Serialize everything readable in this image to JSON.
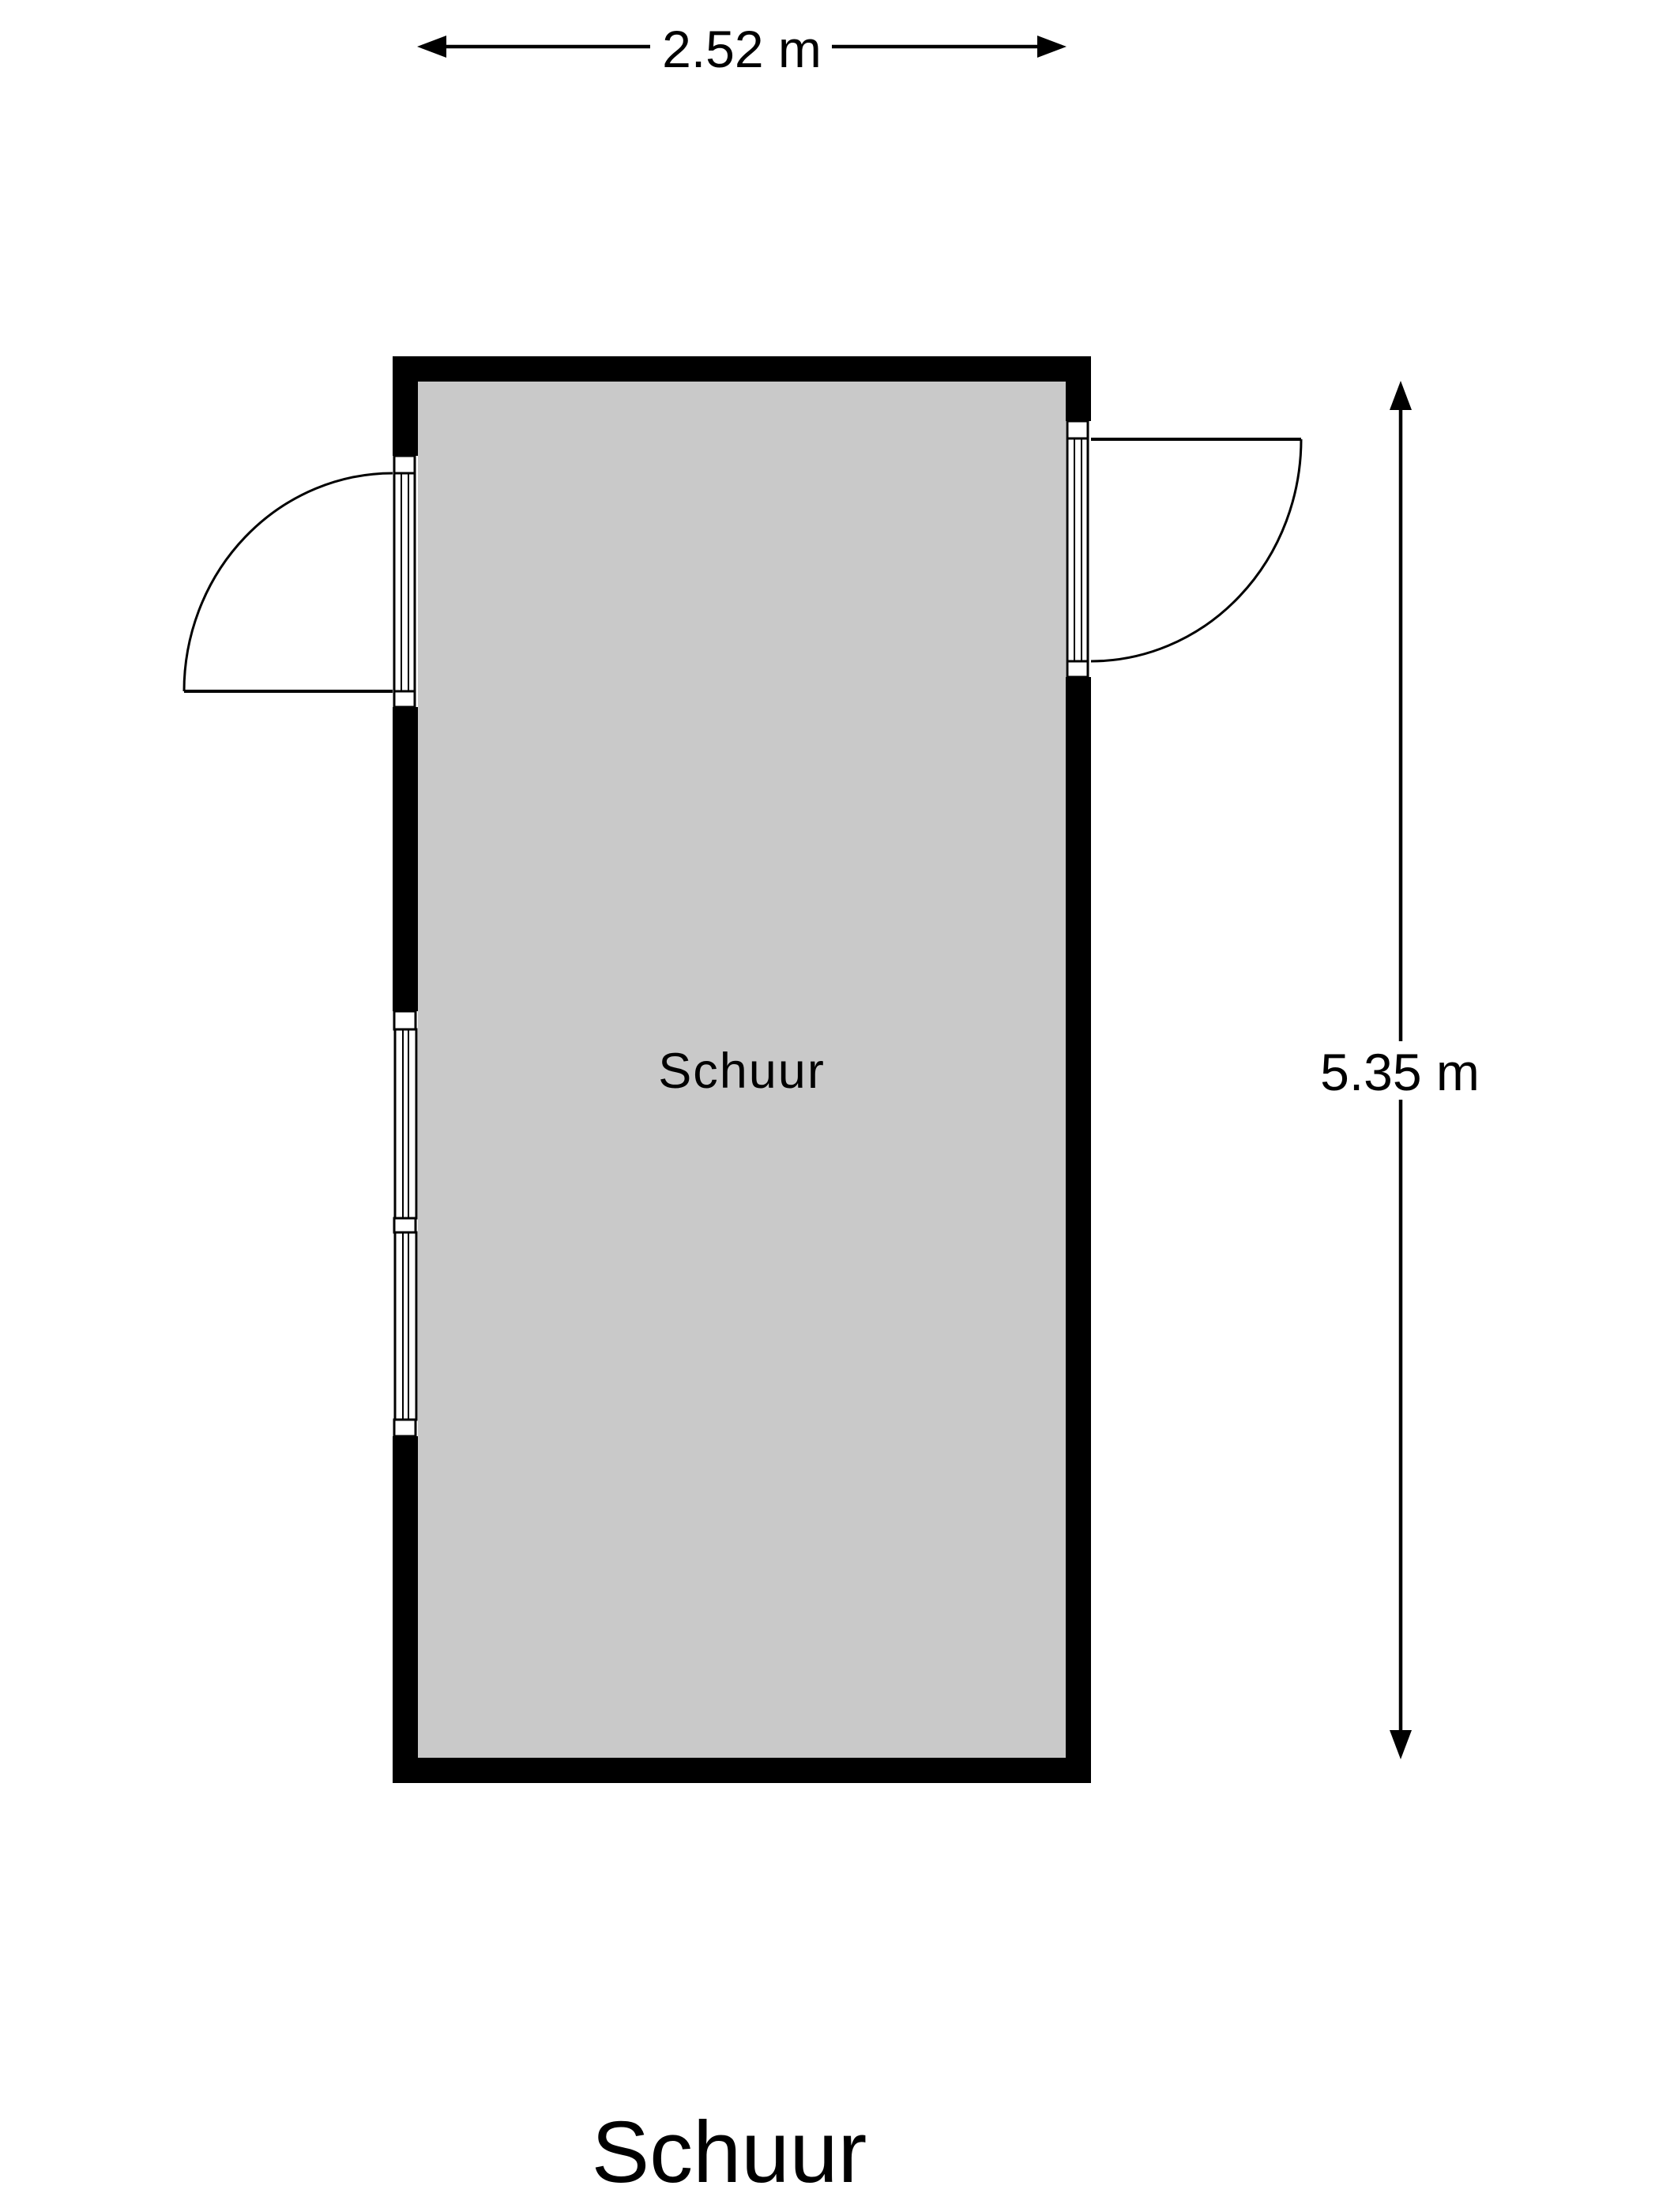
{
  "title": "Schuur",
  "room": {
    "label": "Schuur"
  },
  "dimensions": {
    "width_label": "2.52 m",
    "height_label": "5.35 m"
  },
  "features": {
    "left_door": "hinged door, swings out left",
    "right_door": "hinged door, swings out right",
    "left_window": "double window"
  },
  "colors": {
    "background": "#ffffff",
    "wall": "#000000",
    "floor": "#c9c9c9",
    "line": "#000000",
    "opening": "#ffffff"
  }
}
